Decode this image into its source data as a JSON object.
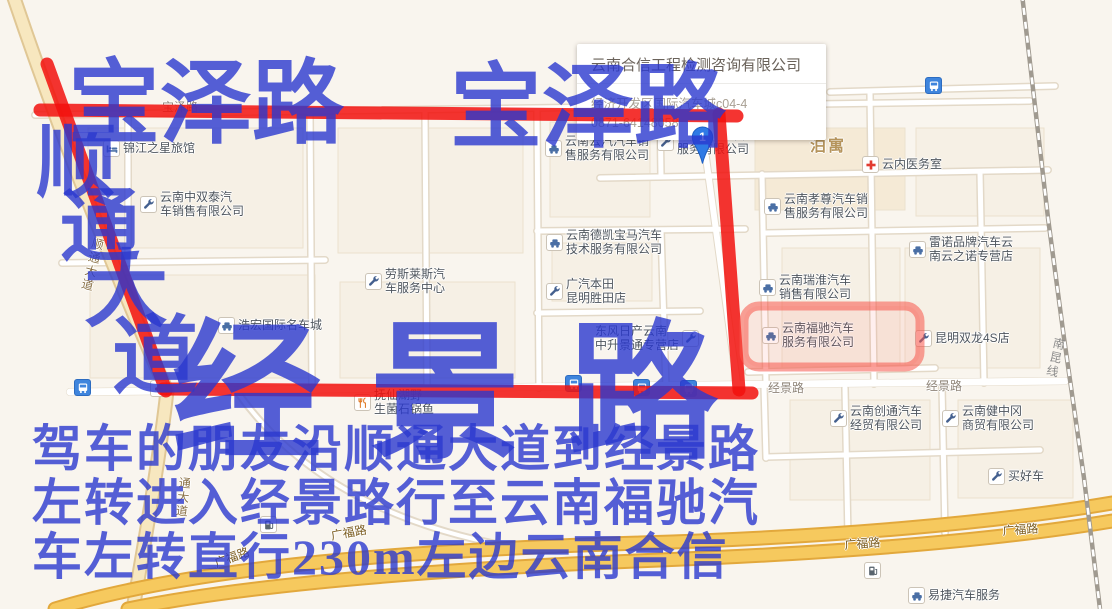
{
  "popup": {
    "title": "云南合信工程检测咨询有限公司",
    "address": "经济开发区国际汽车城c04-4",
    "phone": "0871-64148058"
  },
  "marker": {
    "label": "1"
  },
  "route_annotation": {
    "ink_color": "#2a38ce",
    "line_color": "#f2110d",
    "big_labels": [
      {
        "text": "宝泽路",
        "x": 68,
        "y": 58,
        "size": 92,
        "ls": 0
      },
      {
        "text": "宝泽路",
        "x": 450,
        "y": 62,
        "size": 92,
        "ls": 0
      },
      {
        "text": "顺",
        "x": 36,
        "y": 124,
        "size": 80,
        "ls": 0
      },
      {
        "text": "通",
        "x": 60,
        "y": 188,
        "size": 80,
        "ls": 0
      },
      {
        "text": "大",
        "x": 84,
        "y": 250,
        "size": 84,
        "ls": 0
      },
      {
        "text": "道",
        "x": 112,
        "y": 314,
        "size": 86,
        "ls": 0
      },
      {
        "text": "经景路",
        "x": 172,
        "y": 320,
        "size": 150,
        "ls": 48
      }
    ],
    "instructions": [
      {
        "text": "驾车的朋友沿顺通大道到经景路",
        "x": 32,
        "y": 424,
        "size": 50,
        "ls": 2
      },
      {
        "text": "左转进入经景路行至云南福驰汽",
        "x": 32,
        "y": 478,
        "size": 50,
        "ls": 2
      },
      {
        "text": "车左转直行230m左边云南合信",
        "x": 32,
        "y": 532,
        "size": 50,
        "ls": 2
      }
    ]
  },
  "pois": [
    {
      "name": "锦江之星旅馆",
      "lines": [
        "锦江之星旅馆"
      ],
      "icon": "hotel-icon",
      "x": 103,
      "y": 140
    },
    {
      "name": "云南中双泰汽车销售有限公司",
      "lines": [
        "云南中双泰汽",
        "车销售有限公司"
      ],
      "icon": "wrench-icon",
      "x": 140,
      "y": 191
    },
    {
      "name": "劳斯莱斯汽车服务中心",
      "lines": [
        "劳斯莱斯汽",
        "车服务中心"
      ],
      "icon": "wrench-icon",
      "x": 365,
      "y": 268
    },
    {
      "name": "浩宏国际名车城",
      "lines": [
        "浩宏国际名车城"
      ],
      "icon": "car-icon",
      "x": 218,
      "y": 317
    },
    {
      "name": "云南云汽汽车销售服务有限公司",
      "lines": [
        "云南云汽汽车销",
        "售服务有限公司"
      ],
      "icon": "car-icon",
      "x": 545,
      "y": 135
    },
    {
      "name": "云南德凯宝马汽车技术服务有限公司",
      "lines": [
        "云南德凯宝马汽车",
        "技术服务有限公司"
      ],
      "icon": "car-icon",
      "x": 546,
      "y": 229
    },
    {
      "name": "广汽本田昆明胜田店",
      "lines": [
        "广汽本田",
        "昆明胜田店"
      ],
      "icon": "wrench-icon",
      "x": 546,
      "y": 278
    },
    {
      "name": "东风日产云南中升景通专营店",
      "lines": [
        "东风日产云南",
        "中升景通专营店"
      ],
      "icon": "wrench-icon",
      "x": 595,
      "y": 325,
      "iconSide": "right"
    },
    {
      "name": "云南经华汽车服务有限公司",
      "lines": [
        "云南经华汽车",
        "服务有限公司"
      ],
      "icon": "wrench-icon",
      "x": 657,
      "y": 129
    },
    {
      "name": "泊寓",
      "lines": [
        "泊寓"
      ],
      "icon": null,
      "x": 810,
      "y": 140,
      "cls": "area"
    },
    {
      "name": "云内医务室",
      "lines": [
        "云内医务室"
      ],
      "icon": "hospital-icon",
      "x": 862,
      "y": 156
    },
    {
      "name": "云南孝尊汽车销售服务有限公司",
      "lines": [
        "云南孝尊汽车销",
        "售服务有限公司"
      ],
      "icon": "car-icon",
      "x": 764,
      "y": 193
    },
    {
      "name": "云南瑞淮汽车销售有限公司",
      "lines": [
        "云南瑞淮汽车",
        "销售有限公司"
      ],
      "icon": "car-icon",
      "x": 759,
      "y": 274
    },
    {
      "name": "云南福驰汽车服务有限公司",
      "lines": [
        "云南福驰汽车",
        "服务有限公司"
      ],
      "icon": "car-icon",
      "x": 762,
      "y": 322
    },
    {
      "name": "雷诺品牌汽车云南云之诺专营店",
      "lines": [
        "雷诺品牌汽车云",
        "南云之诺专营店"
      ],
      "icon": "car-icon",
      "x": 909,
      "y": 236
    },
    {
      "name": "昆明双龙4S店",
      "lines": [
        "昆明双龙4S店"
      ],
      "icon": "wrench-icon",
      "x": 915,
      "y": 330
    },
    {
      "name": "抚仙湖野生菌石锅鱼",
      "lines": [
        "抚仙湖野",
        "生菌石锅鱼"
      ],
      "icon": "restaurant-icon",
      "x": 354,
      "y": 389
    },
    {
      "name": "云南创通汽车经贸有限公司",
      "lines": [
        "云南创通汽车",
        "经贸有限公司"
      ],
      "icon": "wrench-icon",
      "x": 830,
      "y": 405
    },
    {
      "name": "云南健中冈商贸有限公司",
      "lines": [
        "云南健中冈",
        "商贸有限公司"
      ],
      "icon": "wrench-icon",
      "x": 942,
      "y": 405
    },
    {
      "name": "买好车",
      "lines": [
        "买好车"
      ],
      "icon": "wrench-icon",
      "x": 988,
      "y": 468
    },
    {
      "name": "易捷汽车服务",
      "lines": [
        "易捷汽车服务"
      ],
      "icon": "car-icon",
      "x": 908,
      "y": 587
    }
  ],
  "standalone_icons": [
    {
      "icon": "bus-icon",
      "x": 74,
      "y": 379
    },
    {
      "icon": "bus-icon",
      "x": 565,
      "y": 375
    },
    {
      "icon": "bus-icon",
      "x": 633,
      "y": 379
    },
    {
      "icon": "bus-icon",
      "x": 680,
      "y": 380
    },
    {
      "icon": "bus-icon",
      "x": 925,
      "y": 77
    },
    {
      "icon": "gas-icon",
      "x": 260,
      "y": 516
    },
    {
      "icon": "gas-icon",
      "x": 864,
      "y": 562
    },
    {
      "icon": "traffic-light-icon",
      "x": 150,
      "y": 380
    }
  ],
  "road_labels": [
    {
      "text": "宝泽路",
      "x": 162,
      "y": 101,
      "cls": "street",
      "rot": 0
    },
    {
      "text": "顺通大道",
      "x": 92,
      "y": 236,
      "cls": "ave v",
      "rot": 14
    },
    {
      "text": "通大道",
      "x": 178,
      "y": 476,
      "cls": "ave v",
      "rot": 6
    },
    {
      "text": "经景路",
      "x": 768,
      "y": 382,
      "cls": "street",
      "rot": 0
    },
    {
      "text": "经景路",
      "x": 926,
      "y": 380,
      "cls": "street",
      "rot": 0
    },
    {
      "text": "广福路",
      "x": 213,
      "y": 558,
      "cls": "hw",
      "rot": -20
    },
    {
      "text": "广福路",
      "x": 330,
      "y": 530,
      "cls": "hw",
      "rot": -10
    },
    {
      "text": "广福路",
      "x": 844,
      "y": 539,
      "cls": "hw",
      "rot": -4
    },
    {
      "text": "广福路",
      "x": 1002,
      "y": 525,
      "cls": "hw",
      "rot": -4
    },
    {
      "text": "南昆线",
      "x": 1053,
      "y": 336,
      "cls": "rail v",
      "rot": 13
    }
  ]
}
